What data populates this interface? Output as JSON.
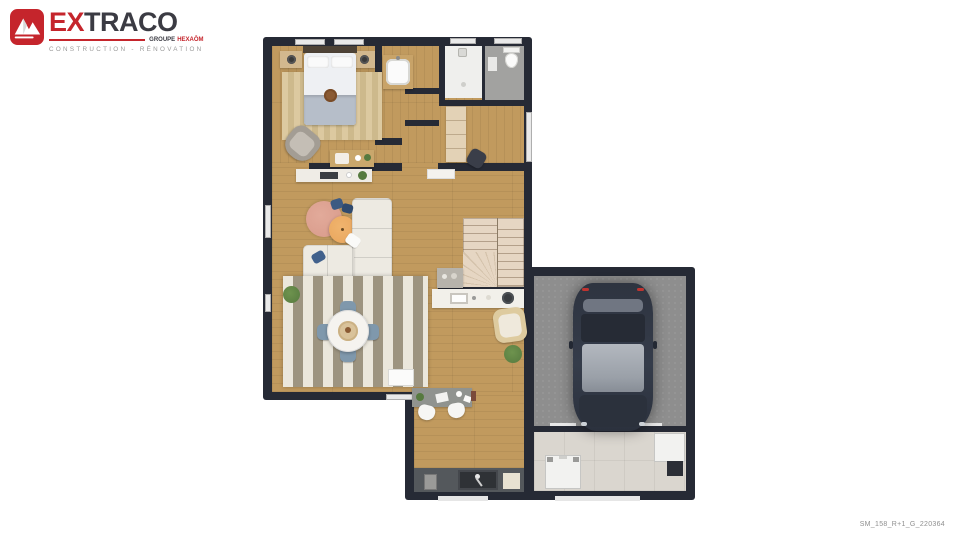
{
  "logo": {
    "brand_prefix": "EX",
    "brand_suffix": "TRACO",
    "group_label": "GROUPE",
    "group_brand": "HEXAŌM",
    "tagline": "CONSTRUCTION - RÉNOVATION"
  },
  "footer": {
    "plan_reference": "SM_158_R+1_G_220364"
  },
  "theme": {
    "colors": {
      "brand-red": "#c5252c",
      "text-dark": "#3b3b43",
      "text-gray": "#9a9a9a",
      "wall": "#262a35",
      "wood": "#c19a5e",
      "rug-beige-a": "#dcc9a0",
      "rug-beige-b": "#cdb98c",
      "rug-cream": "#ebe7dc",
      "rug-taupe": "#9d9480",
      "sofa": "#edeae2",
      "coral-rug": "#d89a8a",
      "pouf-orange": "#e8a55c",
      "chair-blue": "#7f98ac",
      "stair-a": "#e6d6c3",
      "stair-b": "#d4c2ab",
      "garage-floor": "#8e8e8e",
      "tile": "#dad6cf",
      "counter-dark": "#54585c",
      "counter-white": "#f2f0ea",
      "shower-floor": "#efefed",
      "wc-floor": "#a2a2a0",
      "wardrobe": "#e3d2b6",
      "plant-green": "#567a3f",
      "car-body": "#323845"
    }
  }
}
